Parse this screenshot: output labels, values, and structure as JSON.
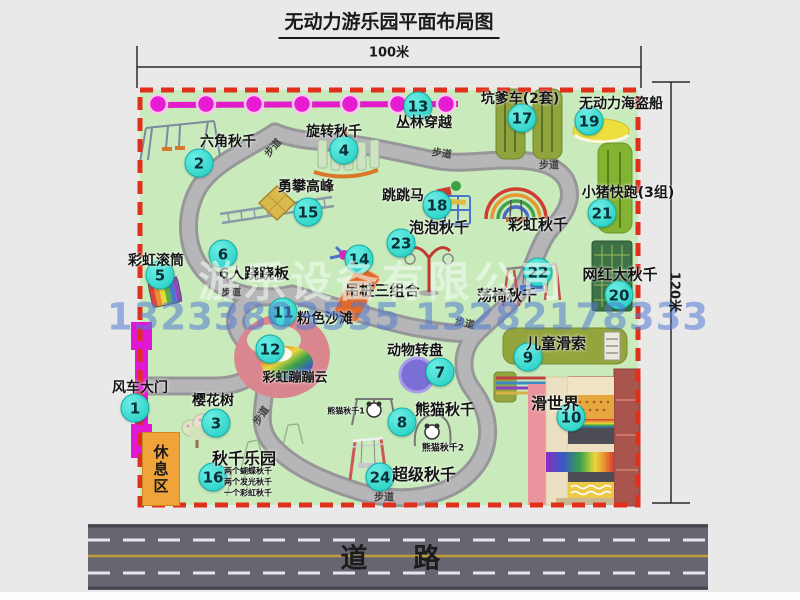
{
  "title": "无动力游乐园平面布局图",
  "dims": {
    "width": "100米",
    "height": "120米"
  },
  "road": {
    "label": "道　路"
  },
  "rest_area": {
    "label": "休息区"
  },
  "watermark": {
    "company": "游乐设备有限公司",
    "phone": "13233803535 13282178333"
  },
  "colors": {
    "park_green": "#c9ebbc",
    "border_red": "#e0301c",
    "badge_cyan": "#1ecbc1",
    "jungle_magenta": "#e81cd2",
    "gate_magenta": "#e018d4",
    "rest_orange": "#f0a338",
    "road_gray": "#666671"
  },
  "attractions": [
    {
      "num": "1",
      "name": "风车大门",
      "bx": 135,
      "by": 408,
      "lx": 140,
      "ly": 387
    },
    {
      "num": "2",
      "name": "六角秋千",
      "bx": 199,
      "by": 163,
      "lx": 228,
      "ly": 141
    },
    {
      "num": "3",
      "name": "樱花树",
      "bx": 216,
      "by": 423,
      "lx": 213,
      "ly": 400
    },
    {
      "num": "4",
      "name": "旋转秋千",
      "bx": 344,
      "by": 150,
      "lx": 334,
      "ly": 131
    },
    {
      "num": "5",
      "name": "彩虹滚筒",
      "bx": 160,
      "by": 275,
      "lx": 156,
      "ly": 260
    },
    {
      "num": "6",
      "name": "6人跷跷板",
      "bx": 223,
      "by": 254,
      "lx": 254,
      "ly": 273,
      "size": 15
    },
    {
      "num": "7",
      "name": "动物转盘",
      "bx": 440,
      "by": 372,
      "lx": 415,
      "ly": 350
    },
    {
      "num": "8",
      "name": "熊猫秋千",
      "bx": 402,
      "by": 422,
      "lx": 445,
      "ly": 409,
      "size": 15
    },
    {
      "num": "9",
      "name": "儿童滑索",
      "bx": 528,
      "by": 357,
      "lx": 556,
      "ly": 343,
      "size": 15
    },
    {
      "num": "10",
      "name": "滑世界",
      "bx": 571,
      "by": 417,
      "lx": 555,
      "ly": 402,
      "size": 16
    },
    {
      "num": "11",
      "name": "粉色沙滩",
      "bx": 283,
      "by": 312,
      "lx": 325,
      "ly": 318
    },
    {
      "num": "12",
      "name": "彩虹蹦蹦云",
      "bx": 270,
      "by": 349,
      "lx": 295,
      "ly": 376,
      "size": 13
    },
    {
      "num": "13",
      "name": "丛林穿越",
      "bx": 418,
      "by": 106,
      "lx": 424,
      "ly": 122
    },
    {
      "num": "14",
      "name": "吊桩三组合",
      "bx": 359,
      "by": 259,
      "lx": 382,
      "ly": 290,
      "size": 15
    },
    {
      "num": "15",
      "name": "勇攀高峰",
      "bx": 308,
      "by": 212,
      "lx": 306,
      "ly": 186
    },
    {
      "num": "16",
      "name": "秋千乐园",
      "bx": 213,
      "by": 477,
      "lx": 244,
      "ly": 457,
      "size": 16
    },
    {
      "num": "17",
      "name": "坑爹车(2套)",
      "bx": 522,
      "by": 118,
      "lx": 520,
      "ly": 98
    },
    {
      "num": "18",
      "name": "跳跳马",
      "bx": 437,
      "by": 205,
      "lx": 403,
      "ly": 195
    },
    {
      "num": "19",
      "name": "无动力海盗船",
      "bx": 589,
      "by": 121,
      "lx": 621,
      "ly": 103
    },
    {
      "num": "20",
      "name": "网红大秋千",
      "bx": 619,
      "by": 295,
      "lx": 620,
      "ly": 274,
      "size": 15
    },
    {
      "num": "21",
      "name": "小猪快跑(3组)",
      "bx": 602,
      "by": 213,
      "lx": 628,
      "ly": 192
    },
    {
      "num": "22",
      "name": "荡椅秋千",
      "bx": 538,
      "by": 272,
      "lx": 507,
      "ly": 295,
      "size": 15
    },
    {
      "num": "23",
      "name": "泡泡秋千",
      "bx": 401,
      "by": 243,
      "lx": 439,
      "ly": 227,
      "size": 15
    },
    {
      "num": "24",
      "name": "超级秋千",
      "bx": 380,
      "by": 477,
      "lx": 424,
      "ly": 473,
      "size": 16
    }
  ],
  "extra_labels": [
    {
      "text": "彩虹秋千",
      "x": 538,
      "y": 224,
      "size": 15
    },
    {
      "text": "熊猫秋千1",
      "x": 346,
      "y": 411,
      "size": 8
    },
    {
      "text": "熊猫秋千2",
      "x": 443,
      "y": 447,
      "size": 9
    },
    {
      "text": "两个蝴蝶秋千",
      "x": 224,
      "y": 471,
      "size": 8,
      "align": "left"
    },
    {
      "text": "两个发光秋千",
      "x": 224,
      "y": 482,
      "size": 8,
      "align": "left"
    },
    {
      "text": "一个彩虹秋千",
      "x": 224,
      "y": 493,
      "size": 8,
      "align": "left"
    }
  ],
  "path_labels": [
    {
      "text": "步道",
      "x": 272,
      "y": 147,
      "rot": -50
    },
    {
      "text": "步道",
      "x": 442,
      "y": 152,
      "rot": 8
    },
    {
      "text": "步道",
      "x": 549,
      "y": 164,
      "rot": 0
    },
    {
      "text": "步道",
      "x": 231,
      "y": 291,
      "rot": 0
    },
    {
      "text": "步道",
      "x": 465,
      "y": 322,
      "rot": 12
    },
    {
      "text": "步道",
      "x": 260,
      "y": 415,
      "rot": -55
    },
    {
      "text": "步道",
      "x": 384,
      "y": 496,
      "rot": 0
    }
  ]
}
